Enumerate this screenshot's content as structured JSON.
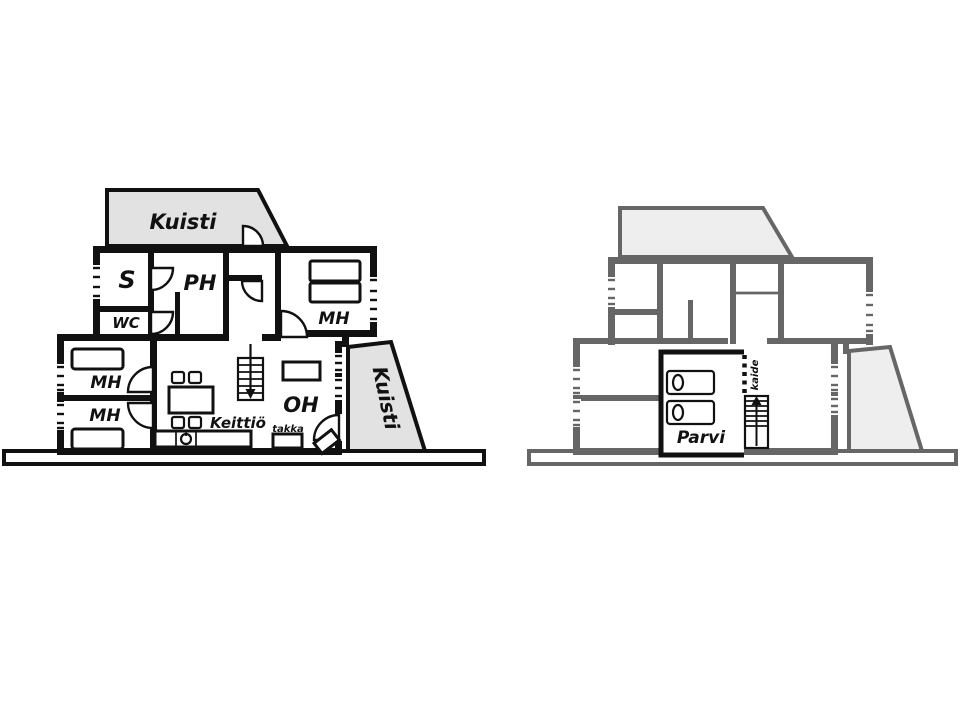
{
  "figure_type": "house floor plans, two levels side by side",
  "colors": {
    "background": "#ffffff",
    "wall_black": "#111111",
    "wall_grey": "#666666",
    "porch_fill_left_plan": "#e2e2e2",
    "porch_fill_right_plan": "#eeeeee"
  },
  "left_plan": {
    "porch_top_label": "Kuisti",
    "sauna_label": "S",
    "wc_label": "WC",
    "washroom_label": "PH",
    "bedroom_top_label": "MH",
    "bedroom_mid_label": "MH",
    "bedroom_low_label": "MH",
    "living_room_label": "OH",
    "kitchen_label": "Keittiö",
    "fireplace_label": "takka",
    "porch_right_label": "Kuisti"
  },
  "right_plan": {
    "loft_label": "Parvi",
    "railing_label": "kaide"
  }
}
